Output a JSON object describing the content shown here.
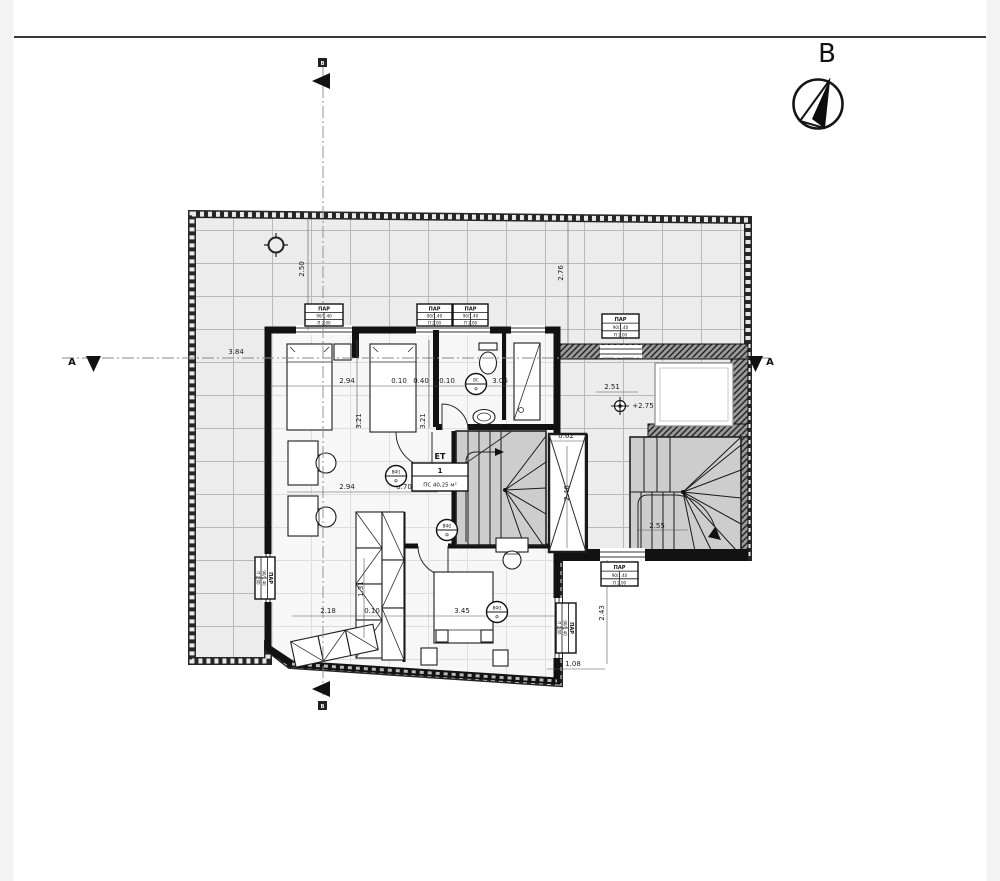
{
  "compass": {
    "label": "B"
  },
  "sections": {
    "a": "A",
    "b": "B"
  },
  "room_label": {
    "floor": "ЕТ",
    "number": "1",
    "area": "ПС 40,25 м²"
  },
  "dimensions": [
    {
      "t": "2.50",
      "x": 304,
      "y": 269,
      "r": -90
    },
    {
      "t": "2.76",
      "x": 563,
      "y": 273,
      "r": -90
    },
    {
      "t": "3.84",
      "x": 236,
      "y": 354,
      "r": 0
    },
    {
      "t": "2.94",
      "x": 347,
      "y": 383,
      "r": 0
    },
    {
      "t": "0.10",
      "x": 399,
      "y": 383,
      "r": 0
    },
    {
      "t": "0.40",
      "x": 421,
      "y": 383,
      "r": 0
    },
    {
      "t": "0.10",
      "x": 447,
      "y": 383,
      "r": 0
    },
    {
      "t": "3.06",
      "x": 500,
      "y": 383,
      "r": 0
    },
    {
      "t": "3.21",
      "x": 361,
      "y": 421,
      "r": -90
    },
    {
      "t": "3.21",
      "x": 425,
      "y": 421,
      "r": -90
    },
    {
      "t": "2.94",
      "x": 347,
      "y": 489,
      "r": 0
    },
    {
      "t": "0.70",
      "x": 404,
      "y": 489,
      "r": 0
    },
    {
      "t": "2.18",
      "x": 328,
      "y": 613,
      "r": 0
    },
    {
      "t": "0.10",
      "x": 372,
      "y": 613,
      "r": 0
    },
    {
      "t": "3.45",
      "x": 462,
      "y": 613,
      "r": 0
    },
    {
      "t": "1.31",
      "x": 363,
      "y": 589,
      "r": -90
    },
    {
      "t": "0.62",
      "x": 566,
      "y": 438,
      "r": 0
    },
    {
      "t": "2.46",
      "x": 569,
      "y": 493,
      "r": -90
    },
    {
      "t": "2.51",
      "x": 612,
      "y": 389,
      "r": 0
    },
    {
      "t": "+2.75",
      "x": 643,
      "y": 408,
      "r": 0
    },
    {
      "t": "2.55",
      "x": 657,
      "y": 528,
      "r": 0
    },
    {
      "t": "2.43",
      "x": 604,
      "y": 613,
      "r": -90
    },
    {
      "t": "1.08",
      "x": 573,
      "y": 666,
      "r": 0
    }
  ],
  "window_tags": [
    {
      "x": 305,
      "y": 304,
      "w": 38,
      "h": 22,
      "rot": 0,
      "lines": [
        "ПАР",
        "90/1.40",
        "П 2.00"
      ]
    },
    {
      "x": 417,
      "y": 304,
      "w": 35,
      "h": 22,
      "rot": 0,
      "lines": [
        "ПАР",
        "90/1.40",
        "П 2.00"
      ]
    },
    {
      "x": 453,
      "y": 304,
      "w": 35,
      "h": 22,
      "rot": 0,
      "lines": [
        "ПАР",
        "90/1.40",
        "П 2.00"
      ]
    },
    {
      "x": 602,
      "y": 314,
      "w": 37,
      "h": 24,
      "rot": 0,
      "lines": [
        "ПАР",
        "90/1.40",
        "П 2.00"
      ]
    },
    {
      "x": 601,
      "y": 562,
      "w": 37,
      "h": 24,
      "rot": 0,
      "lines": [
        "ПАР",
        "90/1.40",
        "П 2.00"
      ]
    },
    {
      "x": 576,
      "y": 603,
      "w": 50,
      "h": 20,
      "rot": 90,
      "lines": [
        "ПАР",
        "90/1.40",
        "П 2.00"
      ]
    },
    {
      "x": 275,
      "y": 557,
      "w": 42,
      "h": 20,
      "rot": 90,
      "lines": [
        "ПАР",
        "90/1.40",
        "П 2.00"
      ]
    }
  ],
  "door_tags": [
    {
      "x": 396,
      "y": 476,
      "top": "ВФ1",
      "bottom": "Ф"
    },
    {
      "x": 447,
      "y": 530,
      "top": "ВФ2",
      "bottom": "Ф"
    },
    {
      "x": 476,
      "y": 384,
      "top": "ВС",
      "bottom": "Ф"
    },
    {
      "x": 497,
      "y": 612,
      "top": "ВФ3",
      "bottom": "Ф"
    }
  ],
  "colors": {
    "terrace_tile": "#ececec",
    "tile_line": "#b9b9b9",
    "stair_fill": "#cdcdcd",
    "wall_dark": "#121212"
  }
}
